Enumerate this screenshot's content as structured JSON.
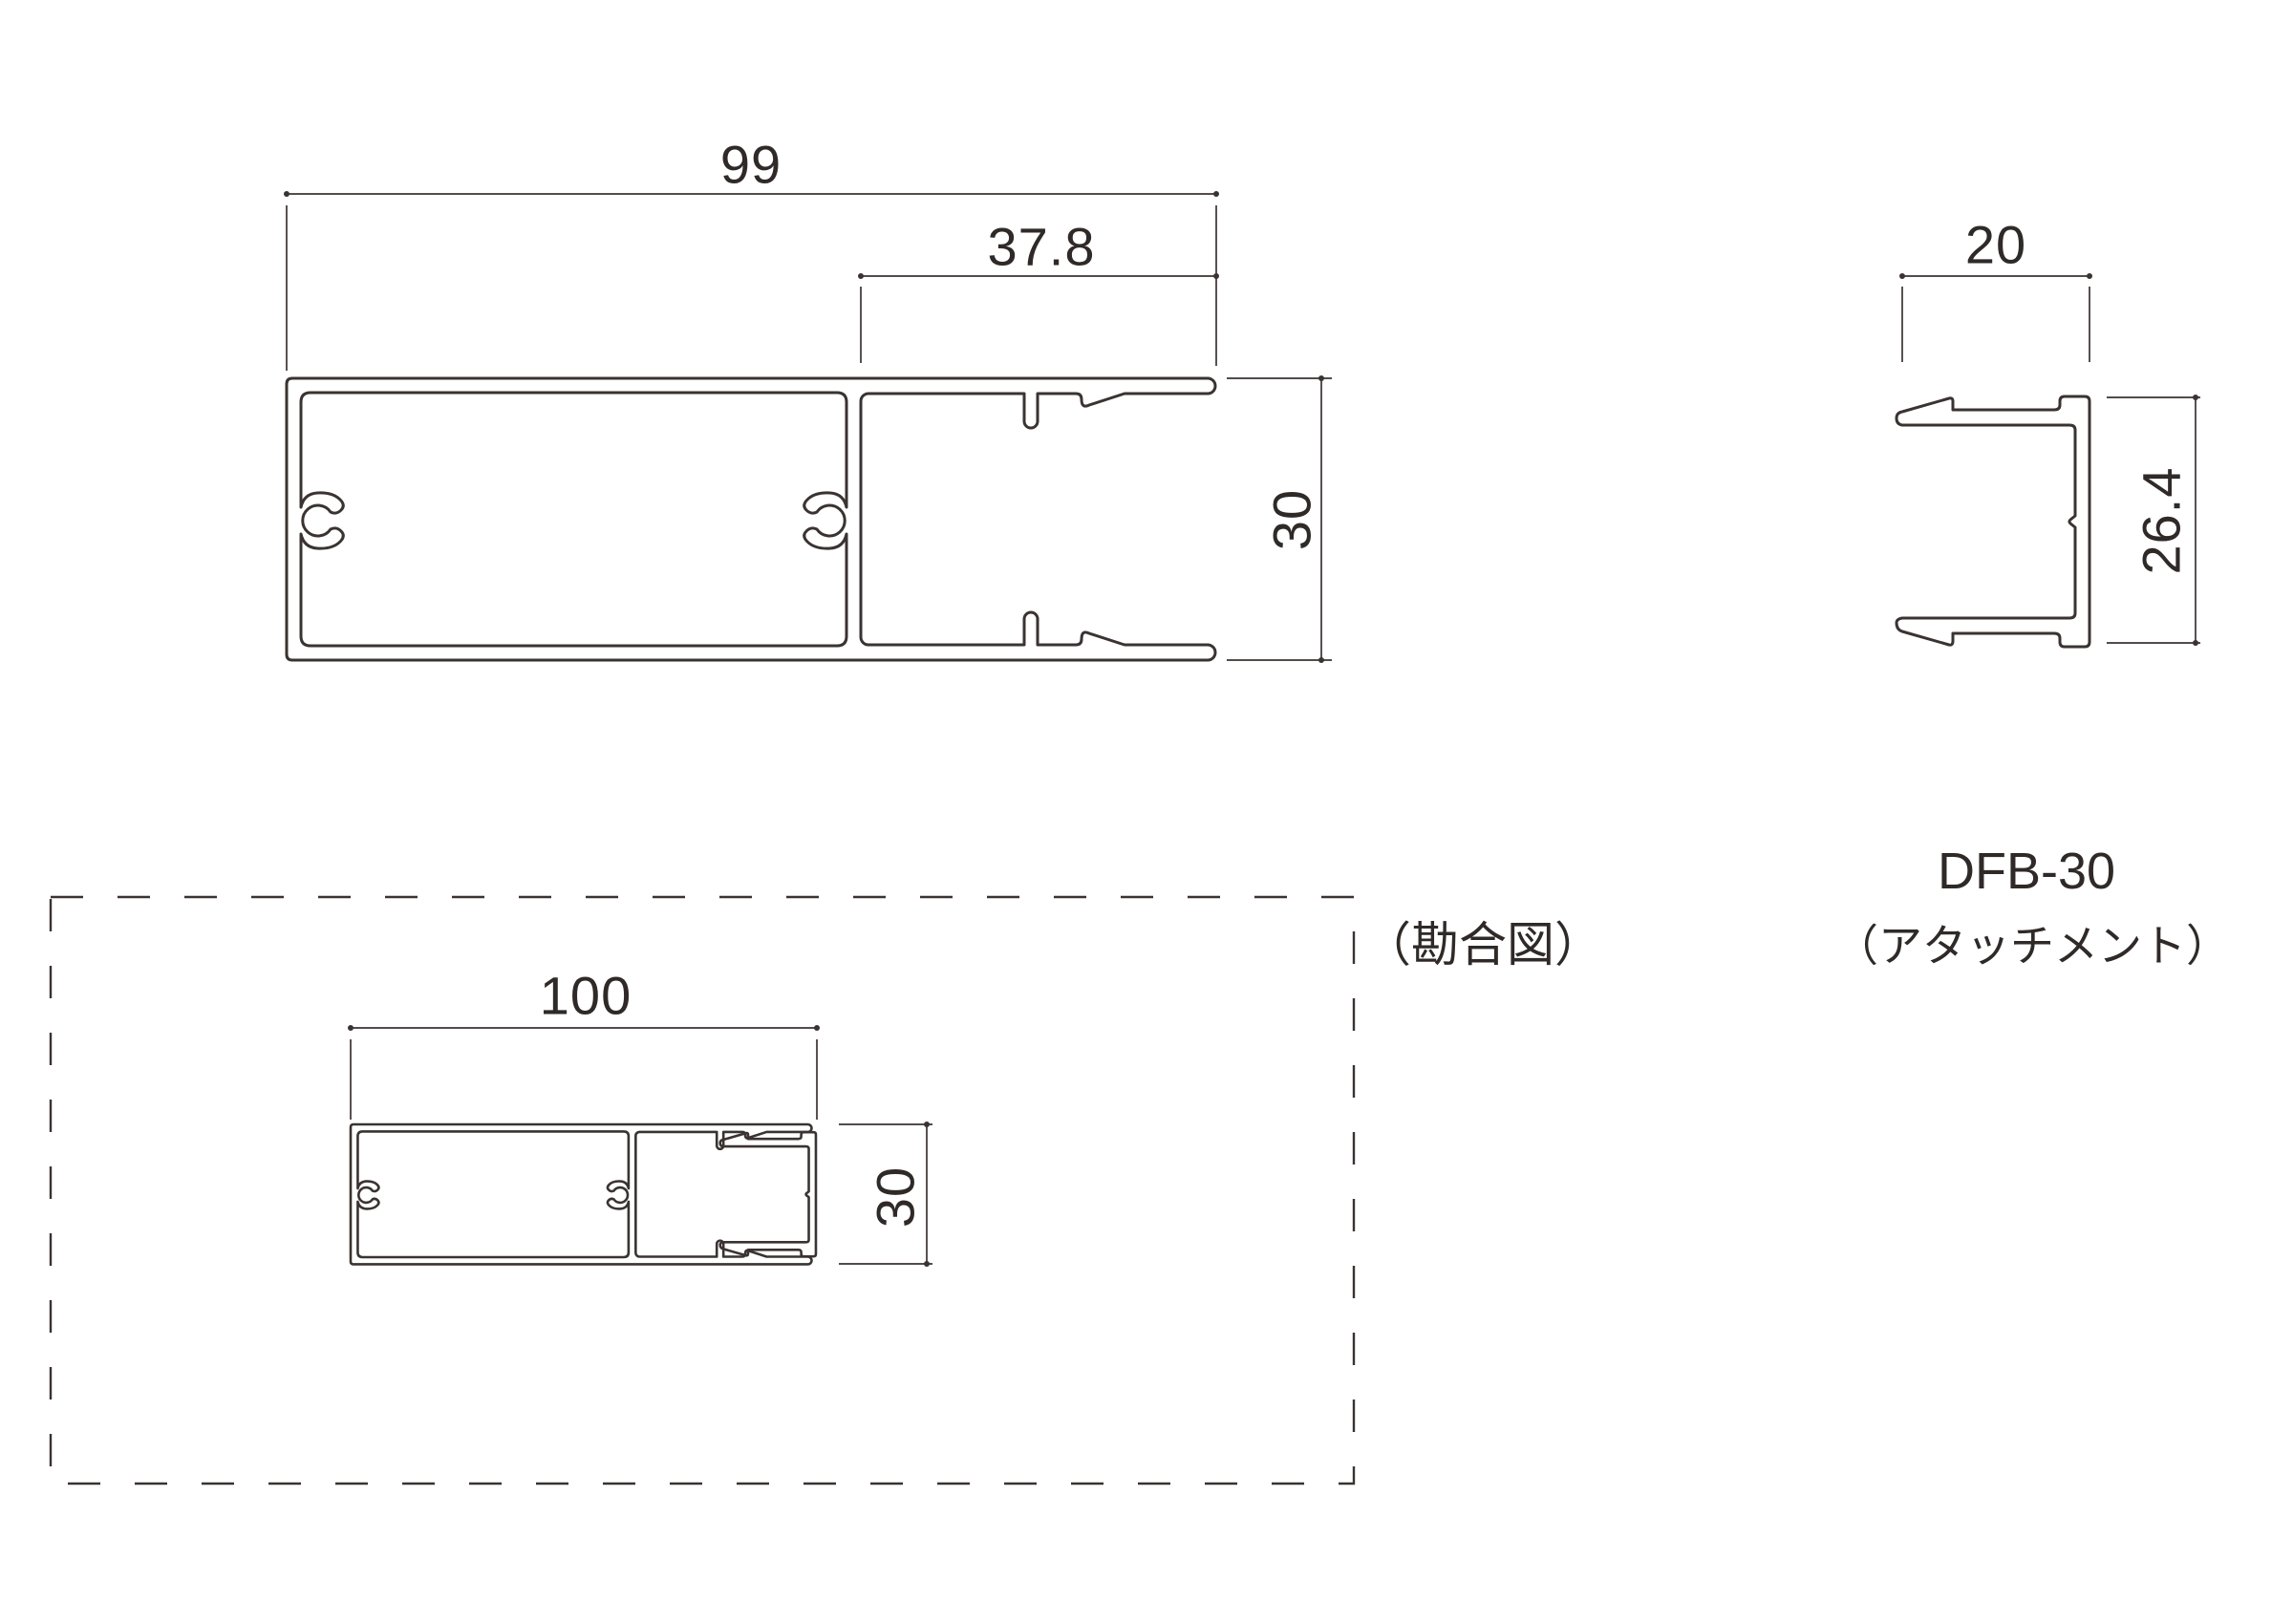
{
  "colors": {
    "line": "#3a3331",
    "text": "#2f2a28",
    "background": "#ffffff"
  },
  "drawing": {
    "main_view": {
      "width_dim": "99",
      "channel_width_dim": "37.8",
      "height_dim": "30"
    },
    "attachment_view": {
      "width_dim": "20",
      "height_dim": "26.4",
      "model_label": "DFB-30",
      "name_label": "（アタッチメント）"
    },
    "assembly_view": {
      "caption": "（勘合図）",
      "width_dim": "100",
      "height_dim": "30"
    }
  }
}
